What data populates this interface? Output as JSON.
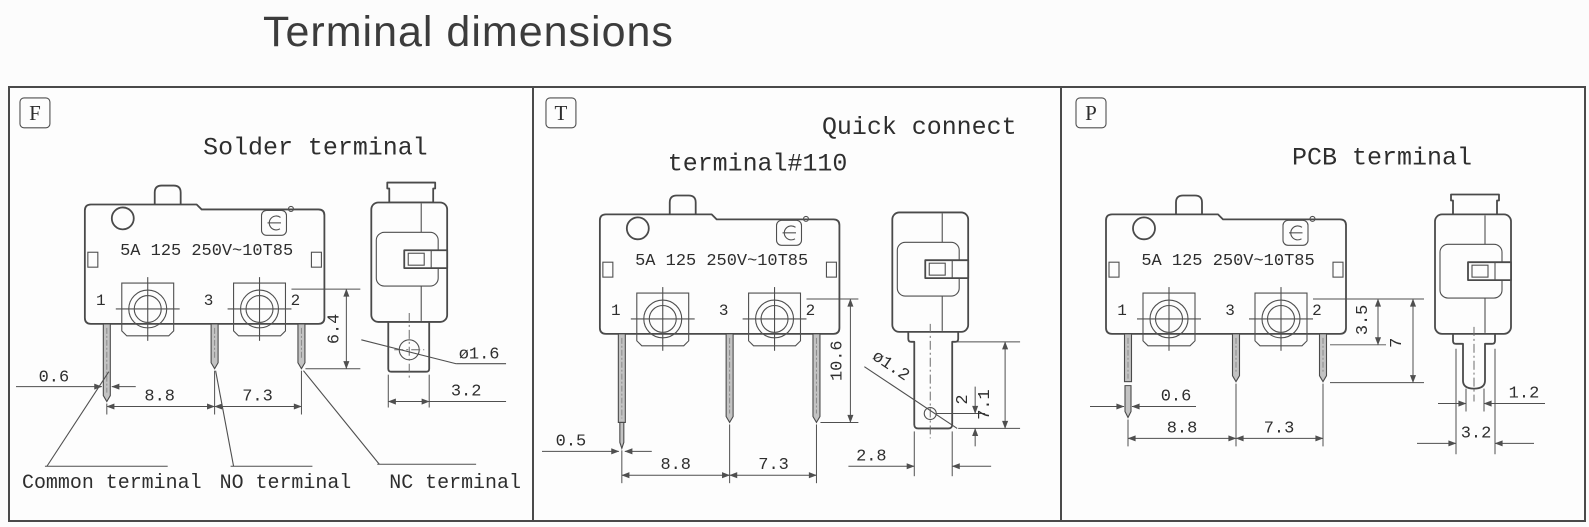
{
  "title": "Terminal dimensions",
  "panels": {
    "f": {
      "badge": "F",
      "title": "Solder terminal",
      "rating": "5A 125 250V~10T85",
      "pin1": "1",
      "pin3": "3",
      "pin2": "2",
      "dim_pin_width": "0.6",
      "dim_span_left": "8.8",
      "dim_span_right": "7.3",
      "dim_pin_length": "6.4",
      "dim_hole_dia": "ø1.6",
      "dim_blade_width": "3.2",
      "label_common": "Common terminal",
      "label_no": "NO terminal",
      "label_nc": "NC terminal"
    },
    "t": {
      "badge": "T",
      "title_line1": "Quick connect",
      "title_line2": "terminal#110",
      "rating": "5A 125 250V~10T85",
      "pin1": "1",
      "pin3": "3",
      "pin2": "2",
      "dim_pin_width": "0.5",
      "dim_span_left": "8.8",
      "dim_span_right": "7.3",
      "dim_pin_length": "10.6",
      "dim_hole_dia": "ø1.2",
      "dim_hole_offset": "2",
      "dim_blade_length": "7.1",
      "dim_blade_width": "2.8"
    },
    "p": {
      "badge": "P",
      "title": "PCB terminal",
      "rating": "5A 125 250V~10T85",
      "pin1": "1",
      "pin3": "3",
      "pin2": "2",
      "dim_pin_width": "0.6",
      "dim_span_left": "8.8",
      "dim_span_right": "7.3",
      "dim_upper": "3.5",
      "dim_total": "7",
      "dim_pin_thickness": "1.2",
      "dim_blade_width": "3.2"
    }
  }
}
